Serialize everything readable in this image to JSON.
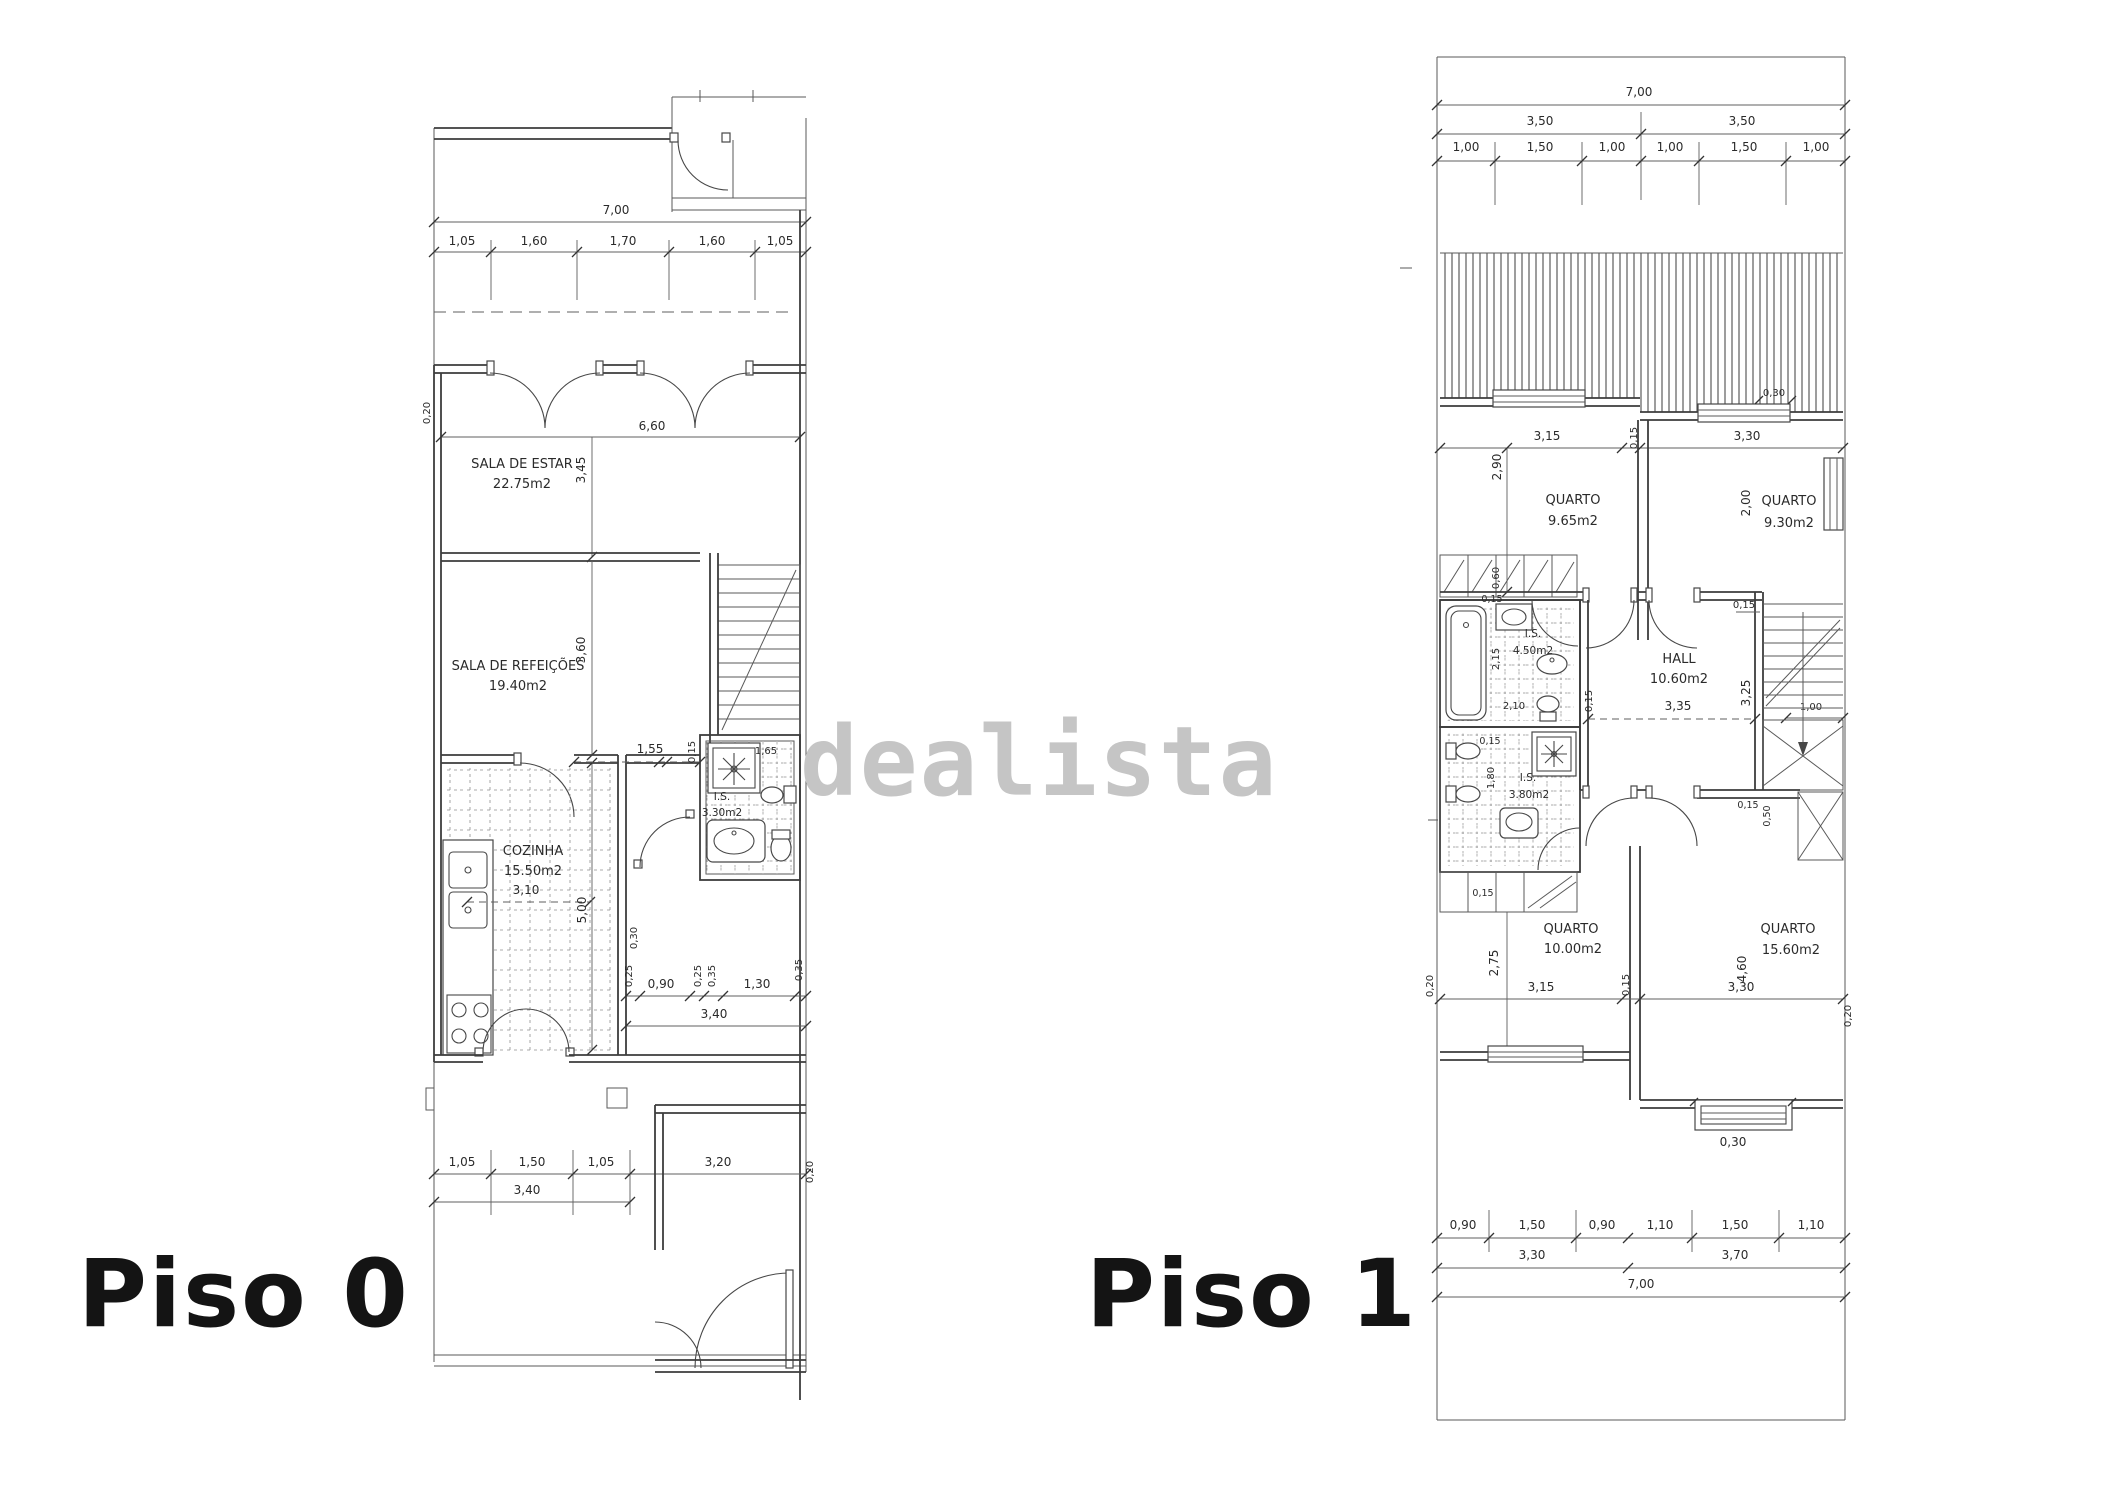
{
  "brand": {
    "watermark_text": "dealista",
    "watermark_color": "#c5c5c5",
    "line_color": "#3d3d3d",
    "label_color": "#141414"
  },
  "floor0": {
    "label": "Piso 0",
    "rooms": {
      "estar": {
        "name": "SALA DE ESTAR",
        "area": "22.75m2"
      },
      "refeicoes": {
        "name": "SALA DE REFEIÇÕES",
        "area": "19.40m2"
      },
      "cozinha": {
        "name": "COZINHA",
        "area": "15.50m2"
      },
      "is": {
        "name": "I.S.",
        "area": "3.30m2"
      }
    },
    "dims": {
      "total": "7,00",
      "top": [
        "1,05",
        "1,60",
        "1,70",
        "1,60",
        "1,05"
      ],
      "wall": "0,20",
      "estar_w": "6,60",
      "estar_d": "3,45",
      "ref_d": "3,60",
      "k_top": [
        "1,55",
        "0,15",
        "1,65"
      ],
      "k_w": "3,10",
      "k_d": "5,00",
      "step": "0,30",
      "hall": [
        "0,25",
        "0,90",
        "0,25",
        "0,35",
        "1,30",
        "0,35"
      ],
      "hall_w": "3,40",
      "yard": [
        "1,05",
        "1,50",
        "1,05",
        "3,20"
      ],
      "yard_w": "3,40",
      "yard_wall": "0,20"
    }
  },
  "floor1": {
    "label": "Piso 1",
    "rooms": {
      "q1": {
        "name": "QUARTO",
        "area": "9.65m2"
      },
      "q2": {
        "name": "QUARTO",
        "area": "9.30m2"
      },
      "hall": {
        "name": "HALL",
        "area": "10.60m2"
      },
      "is1": {
        "name": "I.S.",
        "area": "4.50m2"
      },
      "is2": {
        "name": "I.S.",
        "area": "3.80m2"
      },
      "q3": {
        "name": "QUARTO",
        "area": "10.00m2"
      },
      "q4": {
        "name": "QUARTO",
        "area": "15.60m2"
      }
    },
    "dims": {
      "total_top": "7,00",
      "halves": [
        "3,50",
        "3,50"
      ],
      "top": [
        "1,00",
        "1,50",
        "1,00",
        "1,00",
        "1,50",
        "1,00"
      ],
      "roof_step": "0,30",
      "row1": [
        "3,15",
        "0,15",
        "3,30"
      ],
      "q1_d": "2,90",
      "q2_d": "2,00",
      "closet": "0,60",
      "b1_gap": "0,15",
      "b1_d": "2,15",
      "b1_w": "2,10",
      "hall_w": "3,35",
      "hall_d": "3,25",
      "hall_wall": "0,15",
      "hall_top": "0,15",
      "stair_w": "1,00",
      "b2_gap": "0,15",
      "b2_d": "1,80",
      "ward": [
        "0,15",
        "0,50"
      ],
      "closet2": "0,15",
      "row2": [
        "3,15",
        "0,15",
        "3,30"
      ],
      "q3_d": "2,75",
      "q4_d": "4,60",
      "wall_l": "0,20",
      "wall_r": "0,20",
      "bot_step": "0,30",
      "bottom": [
        "0,90",
        "1,50",
        "0,90",
        "1,10",
        "1,50",
        "1,10"
      ],
      "groups": [
        "3,30",
        "3,70"
      ],
      "total_bottom": "7,00"
    }
  }
}
